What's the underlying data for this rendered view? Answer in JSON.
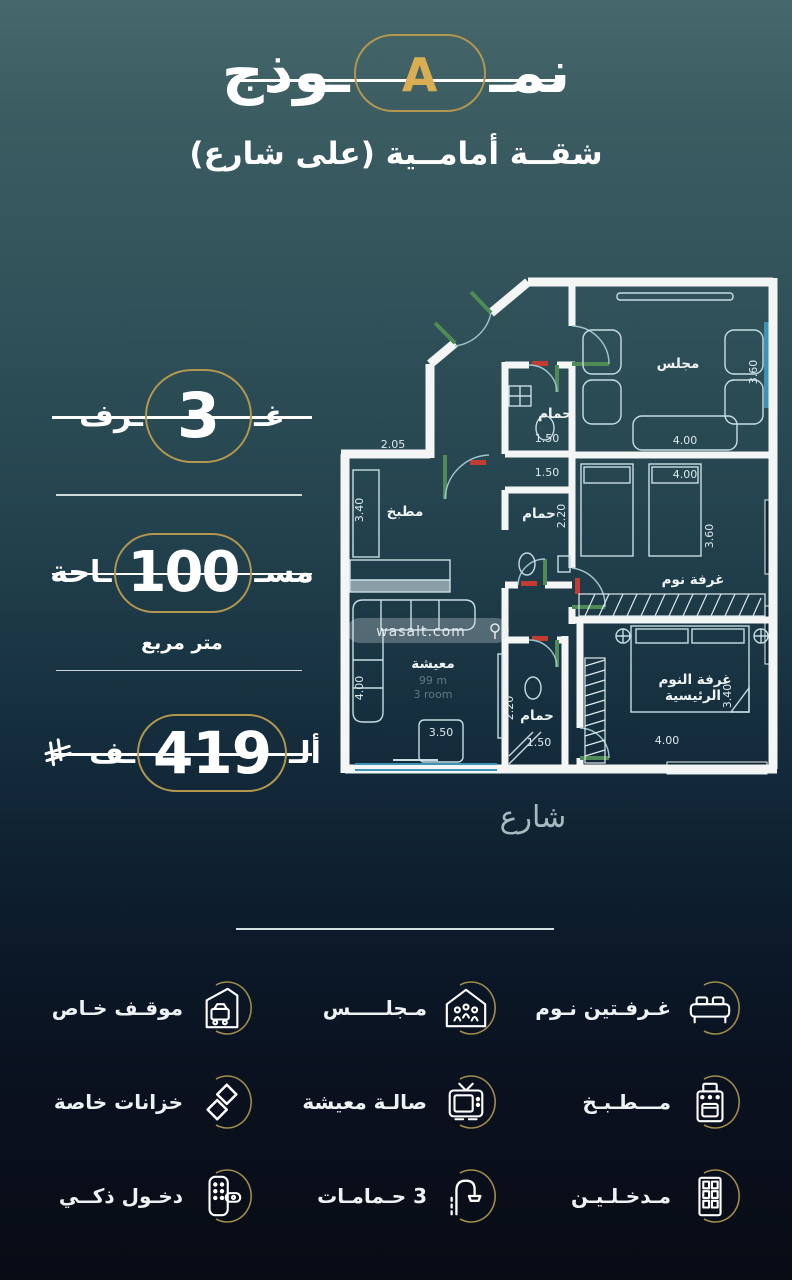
{
  "header": {
    "title_right": "نمـ",
    "title_letter": "A",
    "title_left": "ـوذج",
    "subtitle": "شقــة أمامــية (على شارع)"
  },
  "badges": {
    "rooms": {
      "word_right": "غـ",
      "value": "3",
      "word_left": "ـرف"
    },
    "area": {
      "word_right": "مسـ",
      "value": "100",
      "word_left": "ـاحة",
      "unit": "متر مربع"
    },
    "price": {
      "word_right": "ألـ",
      "value": "419",
      "word_left": "ـف",
      "currency_icon": "saudi-riyal-icon"
    }
  },
  "floor_plan": {
    "street_label": "شارع",
    "watermark": "wasalt.com",
    "rooms": {
      "majlis": {
        "label": "مجلس",
        "width": "4.00",
        "height": "3.60"
      },
      "bedroom": {
        "label": "غرفة نوم",
        "width": "4.00",
        "height": "3.60"
      },
      "master": {
        "label1": "غرفة النوم",
        "label2": "الرئيسية",
        "height": "3.40",
        "width": "4.00"
      },
      "kitchen": {
        "label": "مطبخ",
        "width": "2.05",
        "height": "3.40"
      },
      "living": {
        "label": "معيشة",
        "note1": "99 m",
        "note2": "3 room",
        "height": "4.00",
        "table": "3.50"
      },
      "bath_entry": {
        "label": "حمام",
        "dim": "1.50"
      },
      "bath_mid": {
        "label": "حمام",
        "width": "1.50",
        "height": "2.20"
      },
      "bath_master": {
        "label": "حمام",
        "width": "1.50",
        "height": "2.20"
      },
      "hall": {
        "dim": "1.50"
      }
    }
  },
  "features": {
    "rows": [
      [
        {
          "icon": "bed-icon",
          "label": "غـرفـتين نـوم"
        },
        {
          "icon": "majlis-icon",
          "label": "مـجلـــــس"
        },
        {
          "icon": "parking-icon",
          "label": "موقـف خـاص"
        }
      ],
      [
        {
          "icon": "stove-icon",
          "label": "مـــطـبـخ"
        },
        {
          "icon": "tv-icon",
          "label": "صالـة معيشة"
        },
        {
          "icon": "tanks-icon",
          "label": "خزانات خاصة"
        }
      ],
      [
        {
          "icon": "door-icon",
          "label": "مـدخـلـيـن"
        },
        {
          "icon": "shower-icon",
          "label": "3 حـمامـات"
        },
        {
          "icon": "smart-lock-icon",
          "label": "دخـول ذكــي"
        }
      ]
    ]
  },
  "colors": {
    "gold": "#b3974f",
    "gold_bright": "#d9ad52",
    "wall": "#f3f6f5",
    "accent_green": "#4e8b55"
  }
}
